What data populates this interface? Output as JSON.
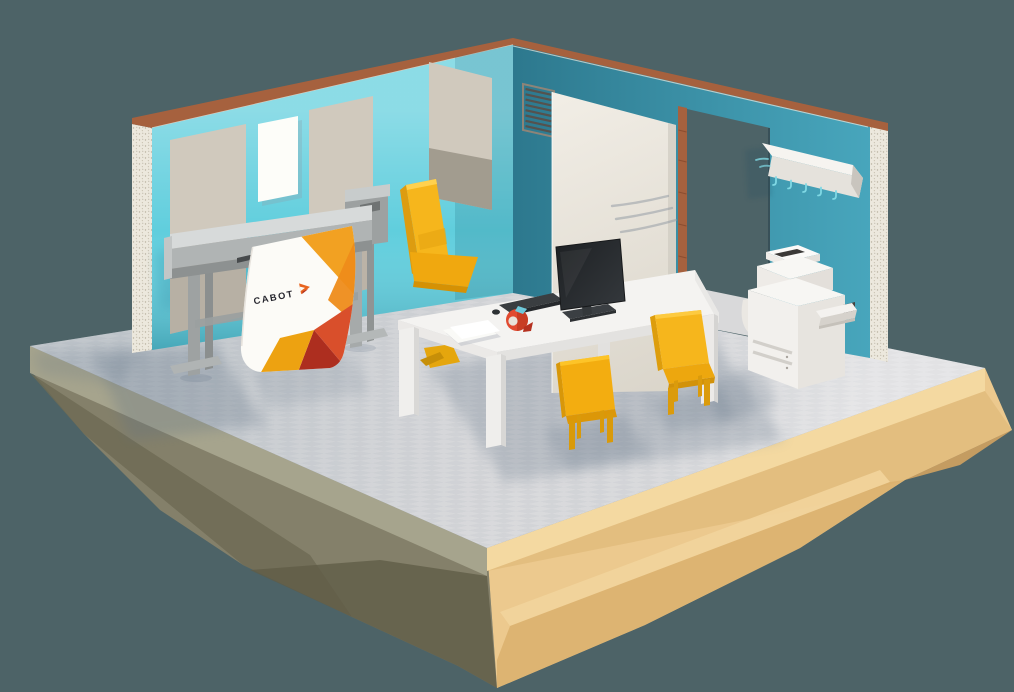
{
  "scene": {
    "banner": {
      "brand": "CABOT"
    },
    "objects": [
      "floating-island",
      "floor",
      "left-wall",
      "right-wall",
      "acoustic-panels",
      "poster-sheet",
      "vent-grille",
      "sliding-door",
      "doorway",
      "coat-rack",
      "large-format-plotter",
      "cabot-banner",
      "desk",
      "office-chair",
      "guest-chair",
      "monitor",
      "keyboard",
      "mouse",
      "tape-dispenser",
      "paper-sheets",
      "multifunction-printer"
    ]
  },
  "colors": {
    "bg": "#4d6367",
    "wall-left": "#60cedd",
    "wall-right": "#3e9db5",
    "copper": "#a6613e",
    "edge-plaster": "#ece8dd",
    "panel-beige": "#d0c9bd",
    "floor": "#dcdcde",
    "island-sand": "#ecc98e",
    "island-shadow": "#84806a",
    "furniture-white": "#f4f3f1",
    "chair-yellow": "#f6b61c",
    "chair-yellow-deep": "#dd9c10",
    "banner-orange": "#f2a122",
    "banner-red": "#d94f2b",
    "banner-dark-red": "#ad2e1f",
    "logo-ink": "#26262e",
    "logo-arrow": "#e8641f",
    "plotter-grey": "#b0b4b4",
    "monitor-dark": "#25282b",
    "tape-red": "#e14a30",
    "hook-teal": "#7fd8e4"
  }
}
